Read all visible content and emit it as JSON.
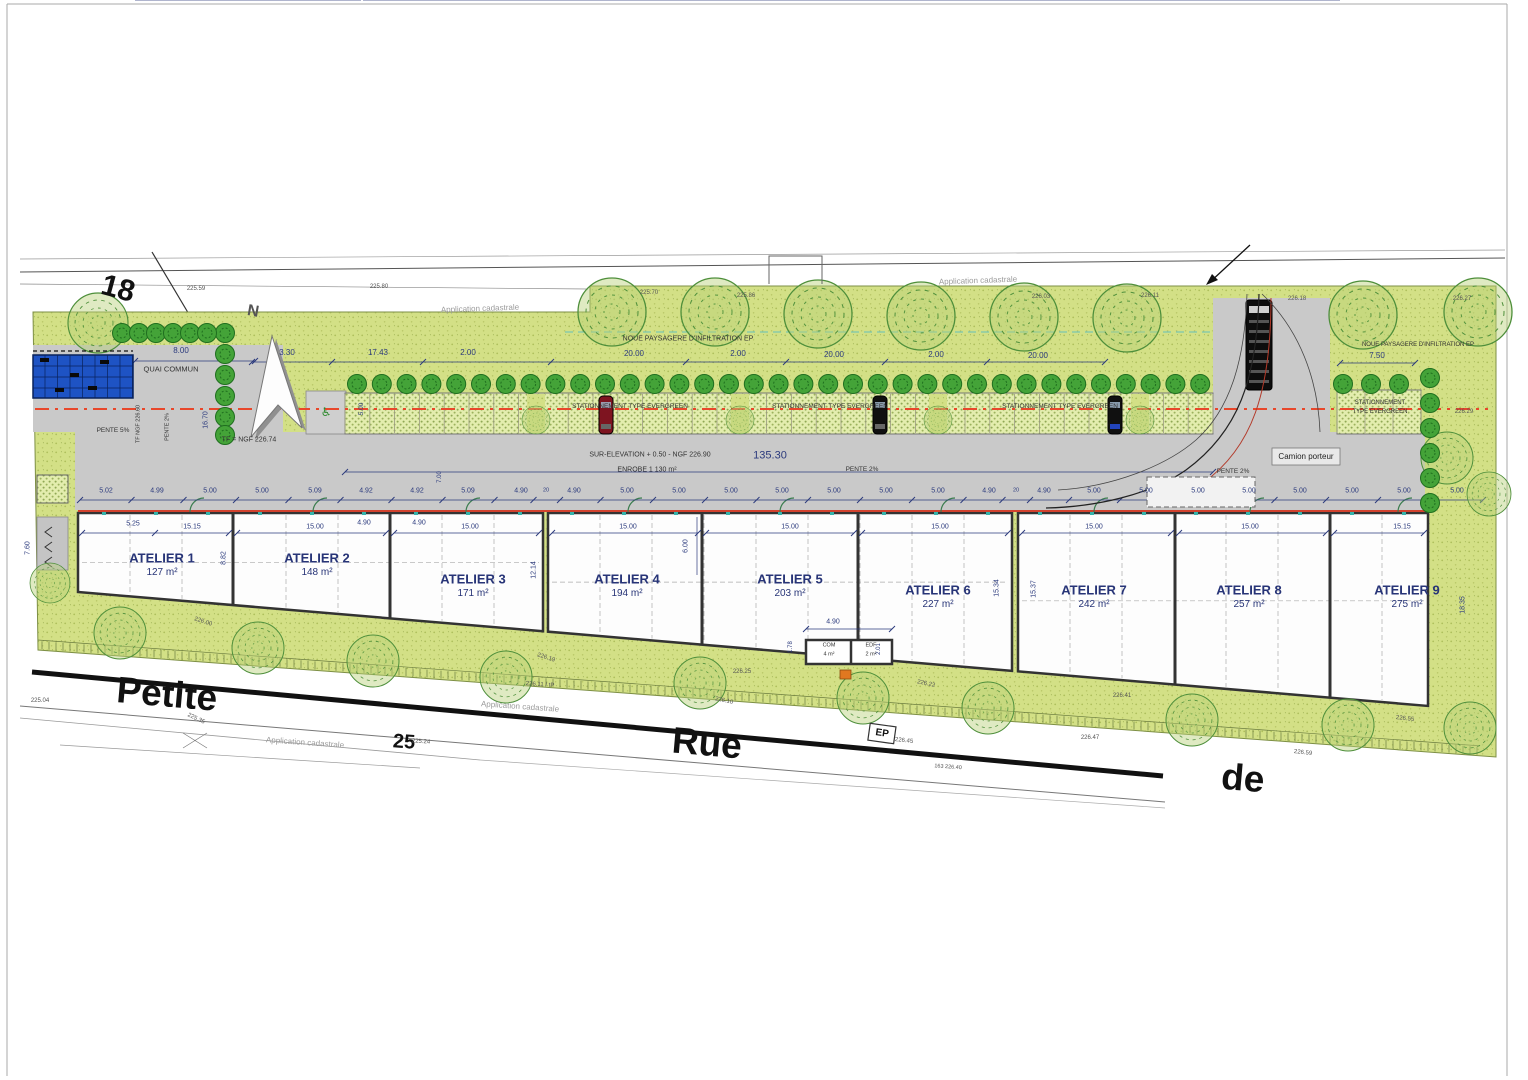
{
  "colors": {
    "grass": "#d3e086",
    "grass_dot": "#aebf5c",
    "paver": "#e3edae",
    "paver_dot": "#90a855",
    "road": "#c9c9c9",
    "wall": "#333333",
    "axis_red": "#e8472b",
    "facade_red": "#d2422e",
    "dim_text": "#2b3a7d",
    "note_text": "#333333",
    "elevation_text": "#555555",
    "tree_outline": "#4e8f3b",
    "tree_small": "#44a338",
    "blue_building": "#1e53c4",
    "street_line": "#111111",
    "teal": "#49b8c8"
  },
  "ateliers": [
    {
      "name": "ATELIER 1",
      "area": "127 m²"
    },
    {
      "name": "ATELIER 2",
      "area": "148 m²"
    },
    {
      "name": "ATELIER 3",
      "area": "171 m²"
    },
    {
      "name": "ATELIER 4",
      "area": "194 m²"
    },
    {
      "name": "ATELIER 5",
      "area": "203 m²"
    },
    {
      "name": "ATELIER 6",
      "area": "227 m²"
    },
    {
      "name": "ATELIER 7",
      "area": "242 m²"
    },
    {
      "name": "ATELIER 8",
      "area": "257 m²"
    },
    {
      "name": "ATELIER 9",
      "area": "275 m²"
    }
  ],
  "rooms": {
    "com": {
      "name": "COM",
      "area": "4 m²"
    },
    "edf": {
      "name": "EDF",
      "area": "2 m²"
    }
  },
  "labels": [
    {
      "t": "18",
      "x": 118,
      "y": 289,
      "fs": 30,
      "c": "#111111",
      "r": 15,
      "b": 1,
      "n": "parcel-number-18"
    },
    {
      "t": "25",
      "x": 404,
      "y": 742,
      "fs": 20,
      "c": "#111111",
      "r": 4,
      "b": 1,
      "n": "parcel-number-25"
    },
    {
      "t": "Petite",
      "x": 167,
      "y": 694,
      "fs": 37,
      "c": "#111111",
      "r": 5,
      "b": 1,
      "n": "street-name-petite"
    },
    {
      "t": "Rue",
      "x": 707,
      "y": 743,
      "fs": 37,
      "c": "#111111",
      "r": 5,
      "b": 1,
      "n": "street-name-rue"
    },
    {
      "t": "de",
      "x": 1243,
      "y": 778,
      "fs": 37,
      "c": "#111111",
      "r": 5,
      "b": 1,
      "n": "street-name-de"
    },
    {
      "t": "Application cadastrale",
      "x": 480,
      "y": 309,
      "fs": 8,
      "c": "#9a9a9a",
      "r": -2,
      "n": "cadastre-note"
    },
    {
      "t": "Application cadastrale",
      "x": 978,
      "y": 281,
      "fs": 8,
      "c": "#9a9a9a",
      "r": -2,
      "n": "cadastre-note"
    },
    {
      "t": "Application cadastrale",
      "x": 520,
      "y": 707,
      "fs": 8,
      "c": "#9a9a9a",
      "r": 4,
      "n": "cadastre-note"
    },
    {
      "t": "Application cadastrale",
      "x": 305,
      "y": 743,
      "fs": 8,
      "c": "#9a9a9a",
      "r": 4,
      "n": "cadastre-note"
    },
    {
      "t": "QUAI COMMUN",
      "x": 171,
      "y": 369,
      "fs": 7.5,
      "c": "#333333",
      "n": "note-quai-commun"
    },
    {
      "t": "NOUE PAYSAGERE D'INFILTRATION EP",
      "x": 688,
      "y": 339,
      "fs": 7,
      "c": "#333333",
      "n": "note-noue"
    },
    {
      "t": "NOUE PAYSAGERE D'INFILTRATION EP",
      "x": 1418,
      "y": 345,
      "fs": 6,
      "c": "#333333",
      "n": "note-noue"
    },
    {
      "t": "STATIONNEMENT TYPE EVERGREEN",
      "x": 630,
      "y": 407,
      "fs": 6.5,
      "c": "#333333",
      "n": "note-parking"
    },
    {
      "t": "STATIONNEMENT TYPE EVERGREEN",
      "x": 830,
      "y": 407,
      "fs": 6.5,
      "c": "#333333",
      "n": "note-parking"
    },
    {
      "t": "STATIONNEMENT TYPE EVERGREEN",
      "x": 1060,
      "y": 407,
      "fs": 6.5,
      "c": "#333333",
      "n": "note-parking"
    },
    {
      "t": "STATIONNEMENT",
      "x": 1380,
      "y": 403,
      "fs": 6,
      "c": "#333333",
      "n": "note-parking"
    },
    {
      "t": "TYPE EVERGREEN",
      "x": 1380,
      "y": 412,
      "fs": 6,
      "c": "#333333",
      "n": "note-parking"
    },
    {
      "t": "SUR-ELEVATION + 0.50 - NGF 226.90",
      "x": 650,
      "y": 455,
      "fs": 7,
      "c": "#333333",
      "n": "note-surelevation"
    },
    {
      "t": "135.30",
      "x": 770,
      "y": 456,
      "fs": 11,
      "n": "dim-overall"
    },
    {
      "t": "ENROBE  1 130 m²",
      "x": 647,
      "y": 470,
      "fs": 7,
      "c": "#333333",
      "n": "note-enrobe"
    },
    {
      "t": "PENTE 2%",
      "x": 862,
      "y": 470,
      "fs": 6.5,
      "c": "#333333",
      "n": "note-pente"
    },
    {
      "t": "PENTE 2%",
      "x": 1233,
      "y": 472,
      "fs": 6.5,
      "c": "#333333",
      "n": "note-pente"
    },
    {
      "t": "PENTE 5%",
      "x": 113,
      "y": 431,
      "fs": 6.5,
      "c": "#333333",
      "n": "note-pente"
    },
    {
      "t": "PENTE 2%",
      "x": 168,
      "y": 427,
      "fs": 5.5,
      "c": "#333333",
      "r": -90,
      "n": "note-pente"
    },
    {
      "t": "TF NGF 226.60",
      "x": 139,
      "y": 424,
      "fs": 5.5,
      "c": "#333333",
      "r": -90,
      "n": "note-tf"
    },
    {
      "t": "TF = NGF 226.74",
      "x": 249,
      "y": 440,
      "fs": 7,
      "c": "#333333",
      "n": "note-tf"
    },
    {
      "t": "Camion porteur",
      "x": 1306,
      "y": 457,
      "fs": 8,
      "c": "#222222",
      "n": "note-camion"
    },
    {
      "t": "EP",
      "x": 882,
      "y": 734,
      "fs": 10,
      "c": "#111111",
      "r": 8,
      "b": 1,
      "n": "ep-marker"
    },
    {
      "t": "N",
      "x": 253,
      "y": 312,
      "fs": 16,
      "c": "#555555",
      "r": 10,
      "b": 1,
      "n": "north-letter"
    },
    {
      "t": "♿",
      "x": 326,
      "y": 412,
      "fs": 12,
      "c": "#2e8b2e",
      "n": "handicap-symbol"
    },
    {
      "t": "3.30",
      "x": 287,
      "y": 353,
      "fs": 8,
      "n": "dim"
    },
    {
      "t": "17.43",
      "x": 378,
      "y": 353,
      "fs": 8,
      "n": "dim"
    },
    {
      "t": "2.00",
      "x": 468,
      "y": 353,
      "fs": 8,
      "n": "dim"
    },
    {
      "t": "20.00",
      "x": 634,
      "y": 354,
      "fs": 8,
      "n": "dim"
    },
    {
      "t": "2.00",
      "x": 738,
      "y": 354,
      "fs": 8,
      "n": "dim"
    },
    {
      "t": "20.00",
      "x": 834,
      "y": 355,
      "fs": 8,
      "n": "dim"
    },
    {
      "t": "2.00",
      "x": 936,
      "y": 355,
      "fs": 8,
      "n": "dim"
    },
    {
      "t": "20.00",
      "x": 1038,
      "y": 356,
      "fs": 8,
      "n": "dim"
    },
    {
      "t": "7.50",
      "x": 1377,
      "y": 356,
      "fs": 8,
      "n": "dim"
    },
    {
      "t": "8.00",
      "x": 181,
      "y": 351,
      "fs": 8,
      "n": "dim"
    },
    {
      "t": "5.02",
      "x": 106,
      "y": 491,
      "fs": 7,
      "n": "dim"
    },
    {
      "t": "4.99",
      "x": 157,
      "y": 491,
      "fs": 7,
      "n": "dim"
    },
    {
      "t": "5.00",
      "x": 210,
      "y": 491,
      "fs": 7,
      "n": "dim"
    },
    {
      "t": "5.00",
      "x": 262,
      "y": 491,
      "fs": 7,
      "n": "dim"
    },
    {
      "t": "5.09",
      "x": 315,
      "y": 491,
      "fs": 7,
      "n": "dim"
    },
    {
      "t": "4.92",
      "x": 366,
      "y": 491,
      "fs": 7,
      "n": "dim"
    },
    {
      "t": "4.92",
      "x": 417,
      "y": 491,
      "fs": 7,
      "n": "dim"
    },
    {
      "t": "5.09",
      "x": 468,
      "y": 491,
      "fs": 7,
      "n": "dim"
    },
    {
      "t": "4.90",
      "x": 521,
      "y": 491,
      "fs": 7,
      "n": "dim"
    },
    {
      "t": "20",
      "x": 546,
      "y": 491,
      "fs": 5.5,
      "n": "dim"
    },
    {
      "t": "4.90",
      "x": 574,
      "y": 491,
      "fs": 7,
      "n": "dim"
    },
    {
      "t": "5.00",
      "x": 627,
      "y": 491,
      "fs": 7,
      "n": "dim"
    },
    {
      "t": "5.00",
      "x": 679,
      "y": 491,
      "fs": 7,
      "n": "dim"
    },
    {
      "t": "5.00",
      "x": 731,
      "y": 491,
      "fs": 7,
      "n": "dim"
    },
    {
      "t": "5.00",
      "x": 782,
      "y": 491,
      "fs": 7,
      "n": "dim"
    },
    {
      "t": "5.00",
      "x": 834,
      "y": 491,
      "fs": 7,
      "n": "dim"
    },
    {
      "t": "5.00",
      "x": 886,
      "y": 491,
      "fs": 7,
      "n": "dim"
    },
    {
      "t": "5.00",
      "x": 938,
      "y": 491,
      "fs": 7,
      "n": "dim"
    },
    {
      "t": "4.90",
      "x": 989,
      "y": 491,
      "fs": 7,
      "n": "dim"
    },
    {
      "t": "20",
      "x": 1016,
      "y": 491,
      "fs": 5.5,
      "n": "dim"
    },
    {
      "t": "4.90",
      "x": 1044,
      "y": 491,
      "fs": 7,
      "n": "dim"
    },
    {
      "t": "5.00",
      "x": 1094,
      "y": 491,
      "fs": 7,
      "n": "dim"
    },
    {
      "t": "5.00",
      "x": 1146,
      "y": 491,
      "fs": 7,
      "n": "dim"
    },
    {
      "t": "5.00",
      "x": 1198,
      "y": 491,
      "fs": 7,
      "n": "dim"
    },
    {
      "t": "5.00",
      "x": 1249,
      "y": 491,
      "fs": 7,
      "n": "dim"
    },
    {
      "t": "5.00",
      "x": 1300,
      "y": 491,
      "fs": 7,
      "n": "dim"
    },
    {
      "t": "5.00",
      "x": 1352,
      "y": 491,
      "fs": 7,
      "n": "dim"
    },
    {
      "t": "5.00",
      "x": 1404,
      "y": 491,
      "fs": 7,
      "n": "dim"
    },
    {
      "t": "5.00",
      "x": 1457,
      "y": 491,
      "fs": 7,
      "n": "dim"
    },
    {
      "t": "5.25",
      "x": 133,
      "y": 524,
      "fs": 7,
      "n": "dim"
    },
    {
      "t": "15.15",
      "x": 192,
      "y": 527,
      "fs": 7,
      "n": "dim"
    },
    {
      "t": "15.00",
      "x": 315,
      "y": 527,
      "fs": 7,
      "n": "dim"
    },
    {
      "t": "4.90",
      "x": 364,
      "y": 523,
      "fs": 7,
      "n": "dim"
    },
    {
      "t": "4.90",
      "x": 419,
      "y": 523,
      "fs": 7,
      "n": "dim"
    },
    {
      "t": "15.00",
      "x": 470,
      "y": 527,
      "fs": 7,
      "n": "dim"
    },
    {
      "t": "15.00",
      "x": 628,
      "y": 527,
      "fs": 7,
      "n": "dim"
    },
    {
      "t": "15.00",
      "x": 790,
      "y": 527,
      "fs": 7,
      "n": "dim"
    },
    {
      "t": "15.00",
      "x": 940,
      "y": 527,
      "fs": 7,
      "n": "dim"
    },
    {
      "t": "15.00",
      "x": 1094,
      "y": 527,
      "fs": 7,
      "n": "dim"
    },
    {
      "t": "15.00",
      "x": 1250,
      "y": 527,
      "fs": 7,
      "n": "dim"
    },
    {
      "t": "15.15",
      "x": 1402,
      "y": 527,
      "fs": 7,
      "n": "dim"
    },
    {
      "t": "8.82",
      "x": 224,
      "y": 558,
      "fs": 7,
      "r": -90,
      "n": "dim"
    },
    {
      "t": "12.14",
      "x": 534,
      "y": 570,
      "fs": 7,
      "r": -90,
      "n": "dim"
    },
    {
      "t": "6.00",
      "x": 686,
      "y": 546,
      "fs": 7,
      "r": -90,
      "n": "dim"
    },
    {
      "t": "15.34",
      "x": 997,
      "y": 588,
      "fs": 7,
      "r": -90,
      "n": "dim"
    },
    {
      "t": "15.37",
      "x": 1034,
      "y": 589,
      "fs": 7,
      "r": -90,
      "n": "dim"
    },
    {
      "t": "18.35",
      "x": 1463,
      "y": 605,
      "fs": 7,
      "r": -90,
      "n": "dim"
    },
    {
      "t": "7.60",
      "x": 28,
      "y": 548,
      "fs": 7,
      "r": -90,
      "n": "dim"
    },
    {
      "t": "5.00",
      "x": 362,
      "y": 409,
      "fs": 6.5,
      "r": -90,
      "n": "dim"
    },
    {
      "t": "1.78",
      "x": 791,
      "y": 647,
      "fs": 6,
      "r": -90,
      "n": "dim"
    },
    {
      "t": "2.01",
      "x": 879,
      "y": 649,
      "fs": 6,
      "r": -90,
      "n": "dim"
    },
    {
      "t": "7.00",
      "x": 440,
      "y": 477,
      "fs": 6,
      "r": -90,
      "n": "dim"
    },
    {
      "t": "16.70",
      "x": 206,
      "y": 420,
      "fs": 7,
      "r": -90,
      "n": "dim"
    },
    {
      "t": "4.90",
      "x": 833,
      "y": 622,
      "fs": 7,
      "n": "dim"
    },
    {
      "t": "225.59",
      "x": 196,
      "y": 289,
      "fs": 6,
      "c": "#555555",
      "n": "elevation"
    },
    {
      "t": "225.80",
      "x": 379,
      "y": 287,
      "fs": 6,
      "c": "#555555",
      "n": "elevation"
    },
    {
      "t": "225.70",
      "x": 649,
      "y": 293,
      "fs": 6,
      "c": "#555555",
      "n": "elevation"
    },
    {
      "t": "225.86",
      "x": 746,
      "y": 296,
      "fs": 6,
      "c": "#555555",
      "n": "elevation"
    },
    {
      "t": "226.03",
      "x": 1041,
      "y": 297,
      "fs": 6,
      "c": "#555555",
      "n": "elevation"
    },
    {
      "t": "226.11",
      "x": 1150,
      "y": 296,
      "fs": 6,
      "c": "#555555",
      "n": "elevation"
    },
    {
      "t": "226.18",
      "x": 1297,
      "y": 299,
      "fs": 6,
      "c": "#555555",
      "n": "elevation"
    },
    {
      "t": "226.27",
      "x": 1462,
      "y": 299,
      "fs": 6,
      "c": "#555555",
      "n": "elevation"
    },
    {
      "t": "226.29",
      "x": 1464,
      "y": 412,
      "fs": 6,
      "c": "#555555",
      "n": "elevation"
    },
    {
      "t": "226.00",
      "x": 203,
      "y": 622,
      "fs": 6,
      "c": "#555555",
      "r": 18,
      "n": "elevation"
    },
    {
      "t": "226.19",
      "x": 546,
      "y": 658,
      "fs": 6,
      "c": "#555555",
      "r": 18,
      "n": "elevation"
    },
    {
      "t": "226.25",
      "x": 742,
      "y": 672,
      "fs": 6,
      "c": "#555555",
      "n": "elevation"
    },
    {
      "t": "226.10",
      "x": 724,
      "y": 701,
      "fs": 6,
      "c": "#555555",
      "r": 12,
      "n": "elevation"
    },
    {
      "t": "226.22",
      "x": 926,
      "y": 684,
      "fs": 6,
      "c": "#555555",
      "r": 12,
      "n": "elevation"
    },
    {
      "t": "226.41",
      "x": 1122,
      "y": 696,
      "fs": 6,
      "c": "#555555",
      "n": "elevation"
    },
    {
      "t": "226.55",
      "x": 1405,
      "y": 719,
      "fs": 6,
      "c": "#555555",
      "r": 6,
      "n": "elevation"
    },
    {
      "t": "226.47",
      "x": 1090,
      "y": 738,
      "fs": 6,
      "c": "#555555",
      "n": "elevation"
    },
    {
      "t": "226.59",
      "x": 1303,
      "y": 753,
      "fs": 6,
      "c": "#555555",
      "r": 6,
      "n": "elevation"
    },
    {
      "t": "225.04",
      "x": 40,
      "y": 701,
      "fs": 6,
      "c": "#555555",
      "n": "elevation"
    },
    {
      "t": "226.11 / tP",
      "x": 540,
      "y": 685,
      "fs": 6,
      "c": "#555555",
      "r": 4,
      "n": "elevation"
    },
    {
      "t": "225.24",
      "x": 421,
      "y": 742,
      "fs": 6,
      "c": "#555555",
      "r": 4,
      "n": "elevation"
    },
    {
      "t": "225.35",
      "x": 196,
      "y": 719,
      "fs": 6,
      "c": "#555555",
      "r": 25,
      "n": "elevation"
    },
    {
      "t": "226.45",
      "x": 904,
      "y": 741,
      "fs": 6,
      "c": "#555555",
      "r": 6,
      "n": "elevation"
    },
    {
      "t": "163  226.40",
      "x": 948,
      "y": 768,
      "fs": 5.5,
      "c": "#555555",
      "r": 4,
      "n": "elevation"
    }
  ]
}
